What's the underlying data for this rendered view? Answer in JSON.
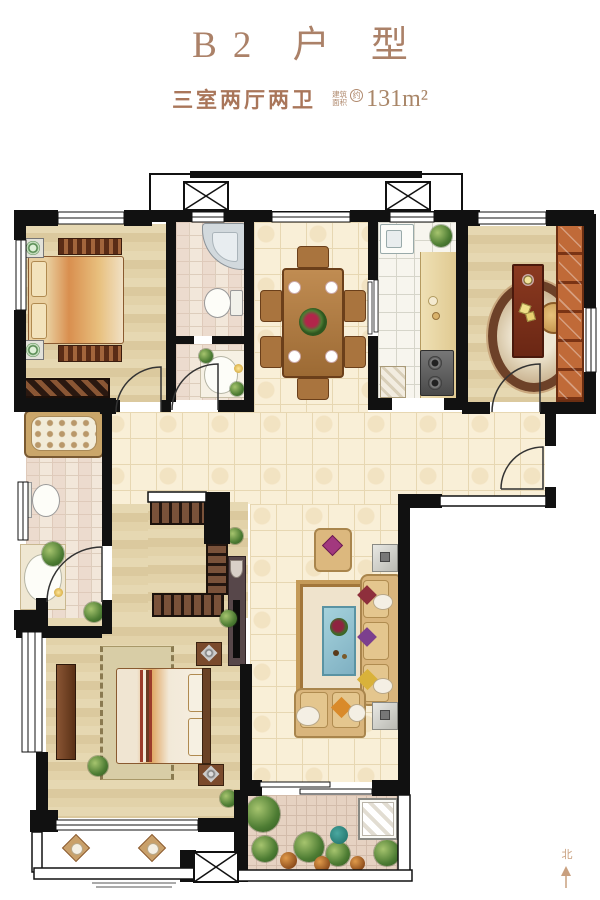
{
  "header": {
    "title": "B2 户 型",
    "subtitle": "三室两厅两卫",
    "area_label_top": "建筑",
    "area_label_bottom": "面积",
    "area_approx": "约",
    "area_value": "131m²"
  },
  "compass": {
    "label": "北",
    "arrow": "↑"
  },
  "palette": {
    "title_text": "#ab8168",
    "subtitle_text": "#a9765a",
    "wall": "#111111",
    "wood_floor": "#ddcba0",
    "tile_floor": "#f8eed6",
    "bath_tile": "#efe3d4",
    "kitchen_floor": "#f6f4ec",
    "balcony_marble": "#ead7b6",
    "garden_tile": "#e4cfc0",
    "furniture_brown": "#8a4b2e",
    "sofa_tan": "#d7b077",
    "coffee_table_blue": "#8fc3cf",
    "bookshelf_orange": "#b4643a"
  },
  "plan": {
    "rooms": [
      {
        "id": "secondary-bedroom",
        "furniture": [
          "double-bed",
          "nightstands",
          "bench"
        ]
      },
      {
        "id": "bathroom",
        "furniture": [
          "corner-bathtub",
          "toilet"
        ]
      },
      {
        "id": "powder-room",
        "furniture": [
          "washbasin"
        ]
      },
      {
        "id": "dining-room",
        "furniture": [
          "dining-table-for-six"
        ]
      },
      {
        "id": "kitchen",
        "furniture": [
          "sink",
          "counter",
          "gas-stove"
        ]
      },
      {
        "id": "study",
        "furniture": [
          "desk",
          "chair",
          "round-rug",
          "bookshelf"
        ]
      },
      {
        "id": "entry-hall",
        "furniture": []
      },
      {
        "id": "master-bathroom",
        "furniture": [
          "bathtub",
          "toilet",
          "washbasin"
        ]
      },
      {
        "id": "walk-in-closet",
        "furniture": [
          "wardrobes"
        ]
      },
      {
        "id": "master-bedroom",
        "furniture": [
          "double-bed",
          "nightstands",
          "dresser",
          "tv-cabinet",
          "rug",
          "plants"
        ]
      },
      {
        "id": "living-room",
        "furniture": [
          "sofa",
          "loveseat",
          "armchair",
          "coffee-table",
          "side-tables",
          "rug"
        ]
      },
      {
        "id": "bedroom-balcony",
        "furniture": [
          "two-chairs"
        ]
      },
      {
        "id": "garden-balcony",
        "furniture": [
          "plants",
          "washing-machine"
        ]
      },
      {
        "id": "duct-shafts",
        "furniture": []
      }
    ]
  }
}
